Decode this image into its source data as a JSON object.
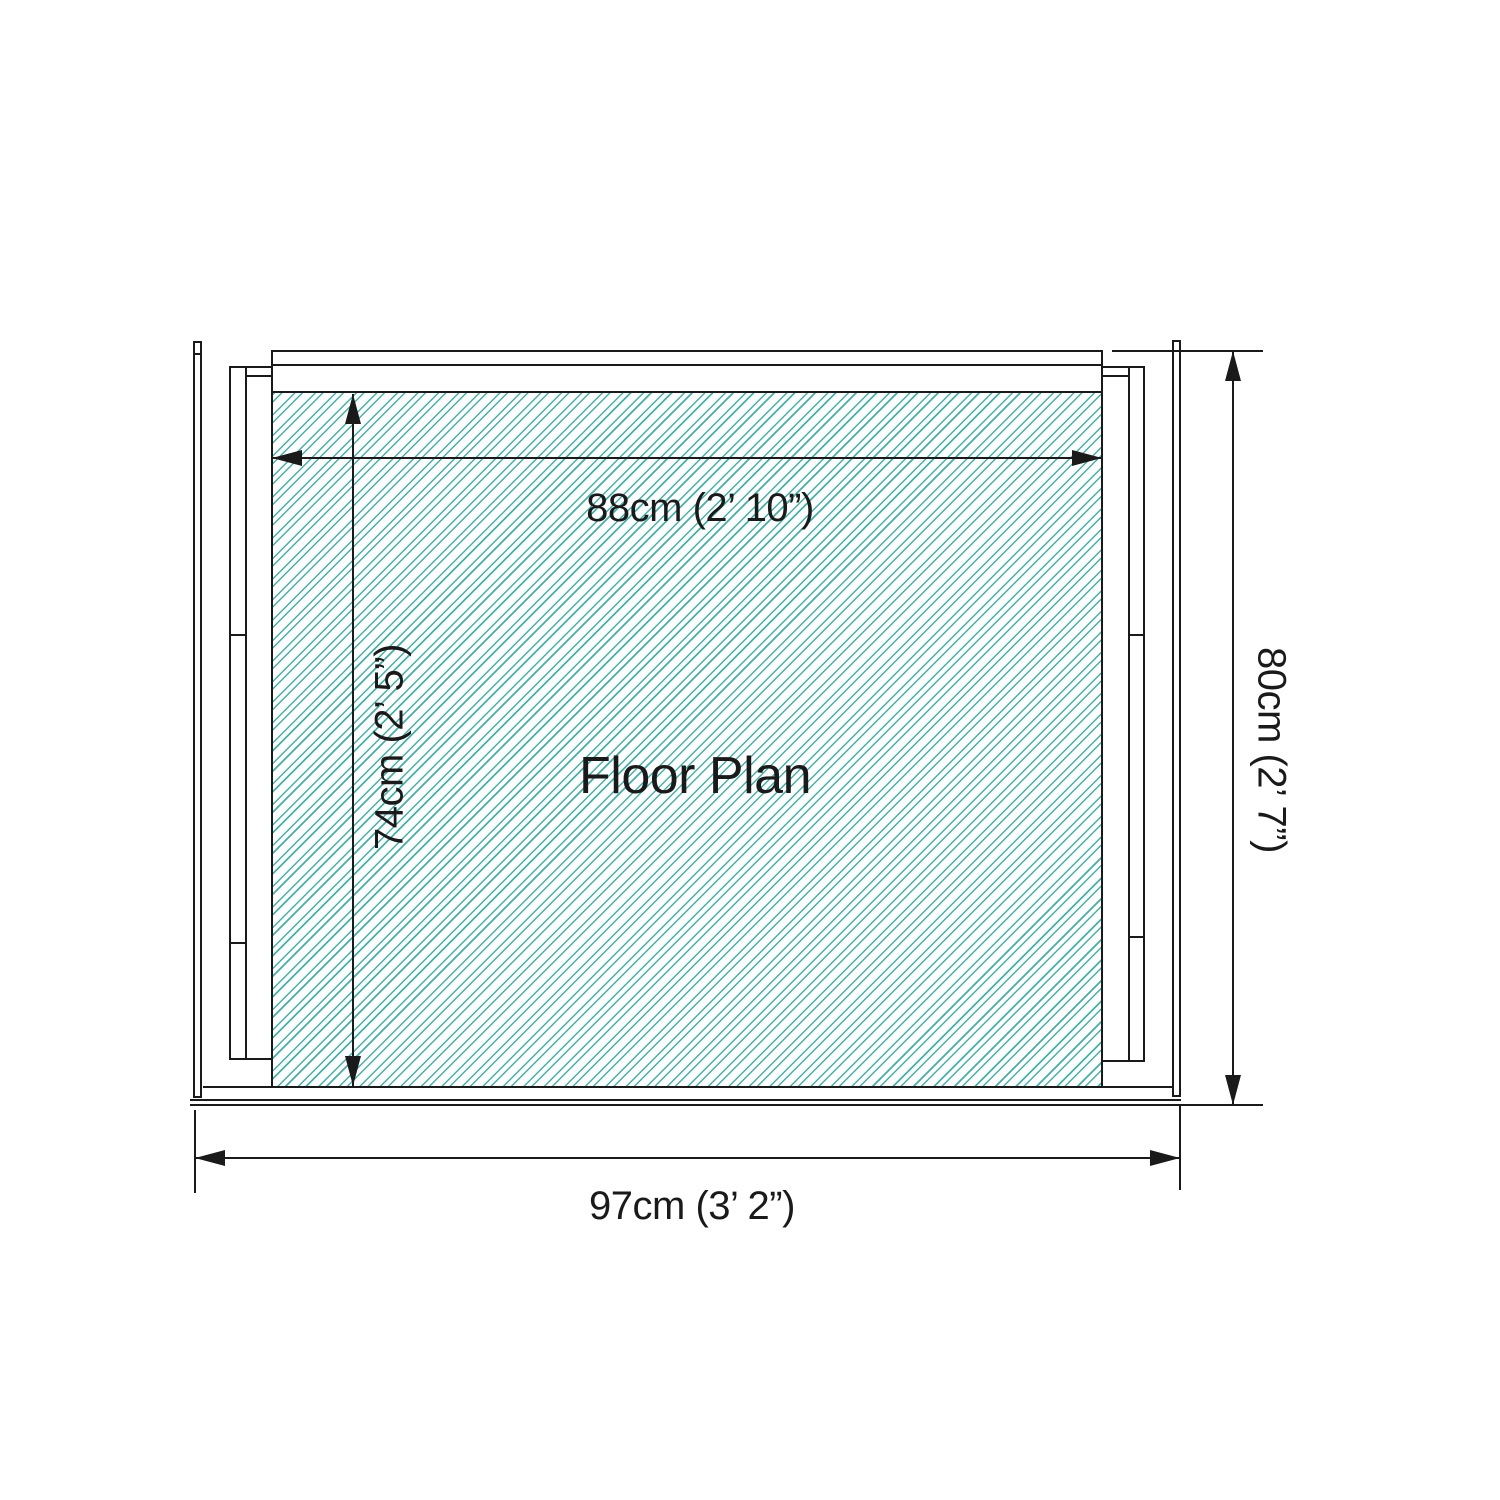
{
  "plan": {
    "title": "Floor Plan",
    "colors": {
      "line": "#1a1a1a",
      "hatch": "#46b1a9",
      "background": "#ffffff"
    },
    "dimensions": {
      "interior_width": {
        "label": "88cm (2’ 10”)"
      },
      "interior_depth": {
        "label": "74cm (2’ 5”)"
      },
      "exterior_width": {
        "label": "97cm (3’ 2”)"
      },
      "exterior_depth": {
        "label": "80cm (2’ 7”)"
      }
    }
  }
}
